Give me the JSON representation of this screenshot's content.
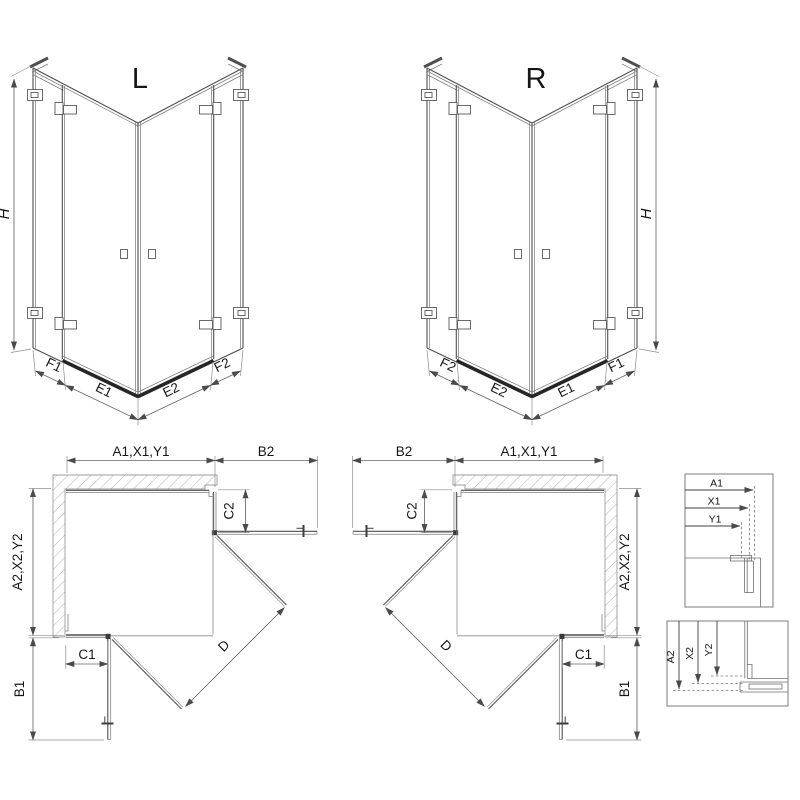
{
  "drawing": {
    "iso_left": {
      "title": "L",
      "height_label": "H",
      "bottom_dims": [
        "F1",
        "E1",
        "E2",
        "F2"
      ]
    },
    "iso_right": {
      "title": "R",
      "height_label": "H",
      "bottom_dims": [
        "F2",
        "E2",
        "E1",
        "F1"
      ]
    },
    "plan_left": {
      "top_width": "A1,X1,Y1",
      "top_door": "B2",
      "right_panel": "C2",
      "side_depth": "A2,X2,Y2",
      "bottom_panel": "C1",
      "bottom_door": "B1",
      "diagonal": "D"
    },
    "plan_right": {
      "top_door": "B2",
      "top_width": "A1,X1,Y1",
      "left_panel": "C2",
      "side_depth": "A2,X2,Y2",
      "bottom_panel": "C1",
      "bottom_door": "B1",
      "diagonal": "D"
    },
    "detail_horizontal": {
      "dims": [
        "A1",
        "X1",
        "Y1"
      ]
    },
    "detail_vertical": {
      "dims": [
        "A2",
        "X2",
        "Y2"
      ]
    }
  }
}
